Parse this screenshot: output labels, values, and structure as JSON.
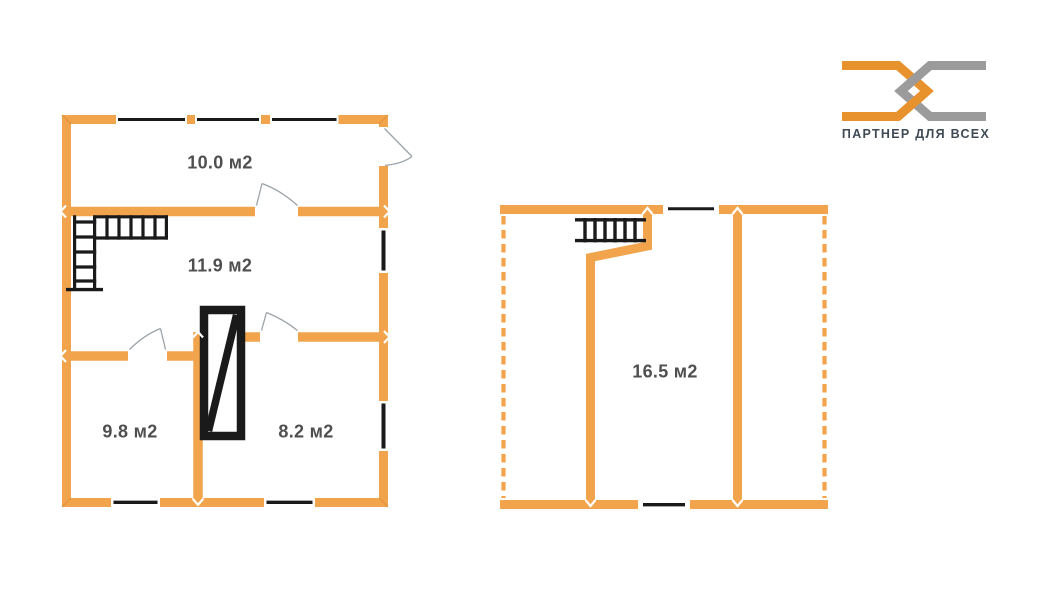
{
  "document": {
    "kind": "real-estate floor plan, two levels",
    "background": "#FFFFFF"
  },
  "palette": {
    "wall_orange": "#F2A44C",
    "corner_seam_orange": "#E0923A",
    "outline_black": "#1A1A1A",
    "door_swing_gray": "#9CA3A8",
    "label_gray": "#4F4F4F",
    "background": "#FFFFFF"
  },
  "logo": {
    "caption": "ПАРТНЕР ДЛЯ ВСЕХ",
    "orange_color": "#E8922D",
    "gray_color": "#9B9B9B",
    "caption_color": "#3F4A55",
    "mark": "two interlocked chevron chain links"
  },
  "floor1": {
    "rooms": [
      {
        "id": "room-top",
        "area_label": "10.0 м2"
      },
      {
        "id": "room-middle",
        "area_label": "11.9 м2"
      },
      {
        "id": "room-bottom-left",
        "area_label": "9.8 м2"
      },
      {
        "id": "room-bottom-right",
        "area_label": "8.2 м2"
      }
    ],
    "symbols": [
      "staircase-icon",
      "stove-icon",
      "window-icon",
      "door-swing-icon"
    ]
  },
  "floor2": {
    "rooms": [
      {
        "id": "room-attic",
        "area_label": "16.5 м2"
      }
    ],
    "symbols": [
      "staircase-icon",
      "window-icon",
      "dashed-eaves-line"
    ]
  }
}
